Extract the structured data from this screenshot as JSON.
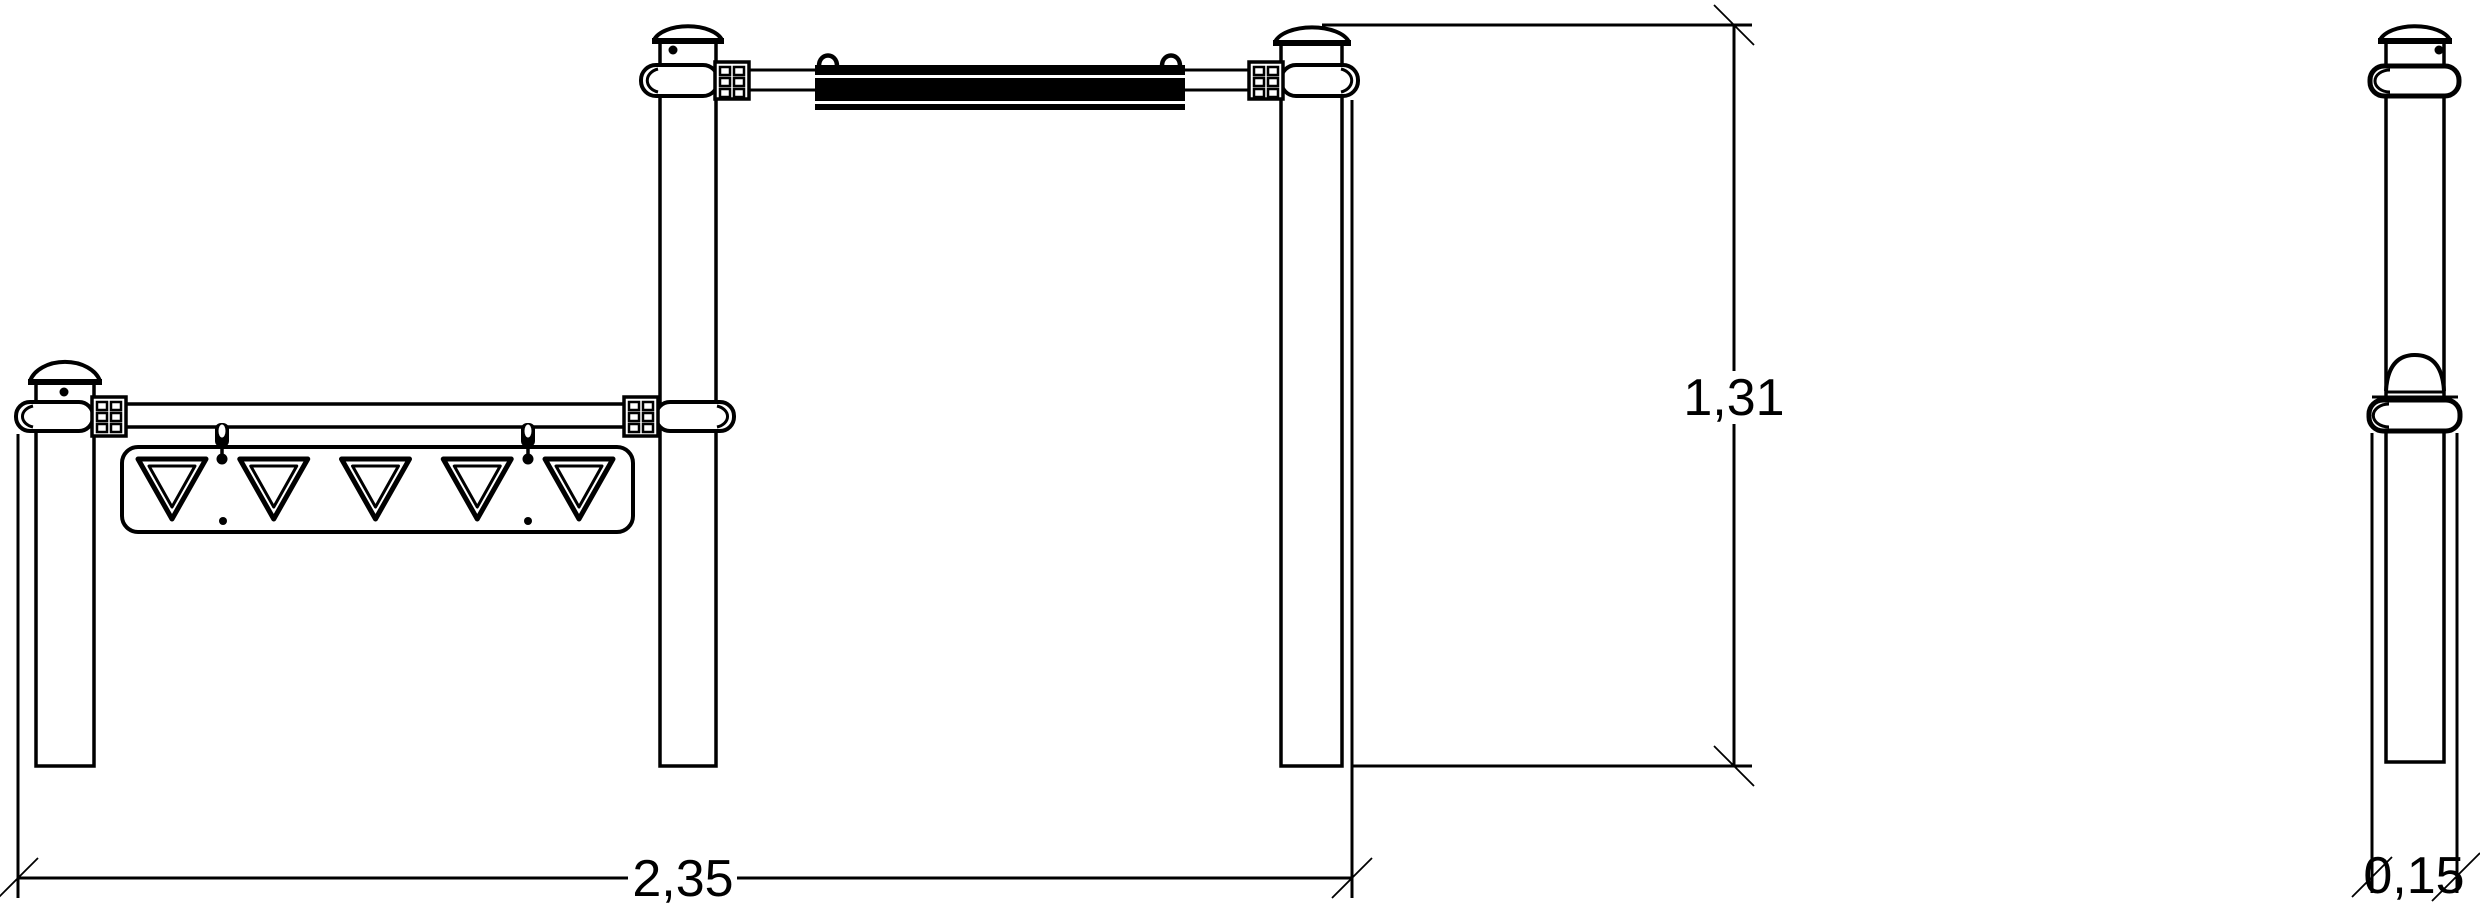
{
  "drawing": {
    "kind": "technical elevation drawing",
    "subject": "outdoor fitness pull-up bar unit with low bar and sign panel",
    "views": {
      "front": "front elevation",
      "side": "side elevation"
    }
  },
  "dims": {
    "height": "1,31",
    "width": "2,35",
    "depth": "0,15"
  },
  "panel": {
    "triangle_count": 5
  },
  "colors": {
    "line": "#000000",
    "background": "#ffffff",
    "grip_sleeve": "#000000"
  }
}
